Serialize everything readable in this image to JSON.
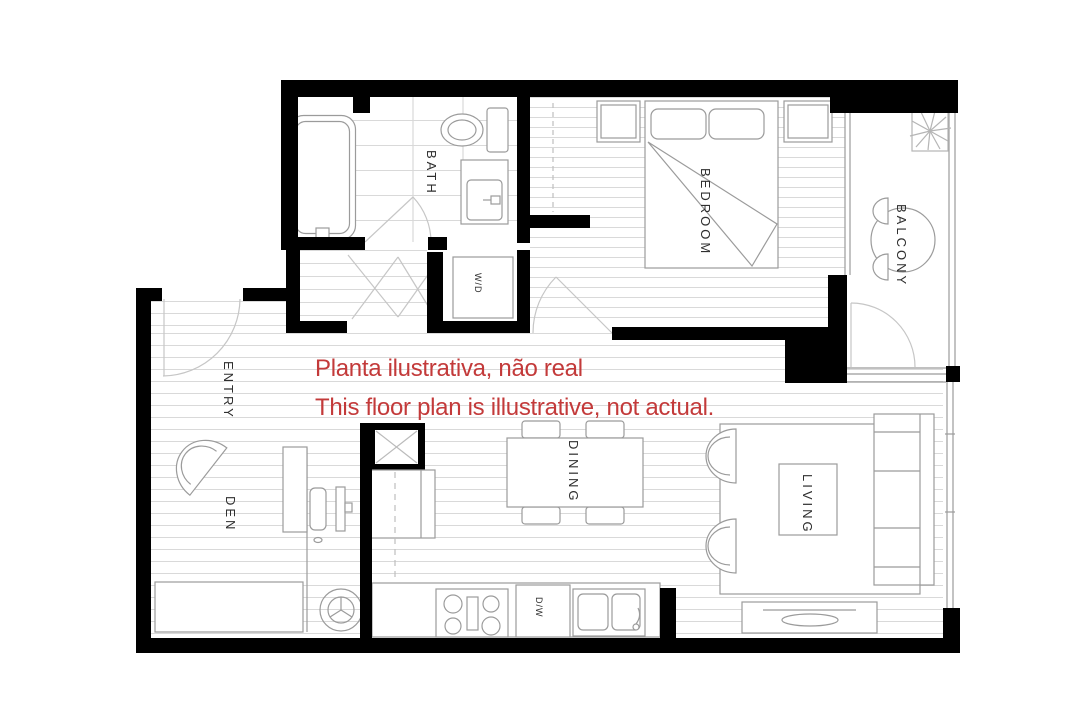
{
  "disclaimer": {
    "line1": "Planta ilustrativa, não real",
    "line2": "This floor plan is illustrative, not actual."
  },
  "rooms": {
    "bath": {
      "label": "BATH"
    },
    "bedroom": {
      "label": "BEDROOM"
    },
    "balcony": {
      "label": "BALCONY"
    },
    "entry": {
      "label": "ENTRY"
    },
    "den": {
      "label": "DEN"
    },
    "dining": {
      "label": "DINING"
    },
    "living": {
      "label": "LIVING"
    }
  },
  "appliances": {
    "washer_dryer": {
      "label": "W/D"
    },
    "dishwasher": {
      "label": "D/W"
    }
  },
  "colors": {
    "wall": "#000000",
    "disclaimer_red": "#c33a3a",
    "furniture_line": "#9b9b9b",
    "floor_line": "#d9d9d9",
    "label_text": "#2e2e2e",
    "door_arc": "#c6c6c6",
    "dashed_line": "#bfbfbf"
  }
}
